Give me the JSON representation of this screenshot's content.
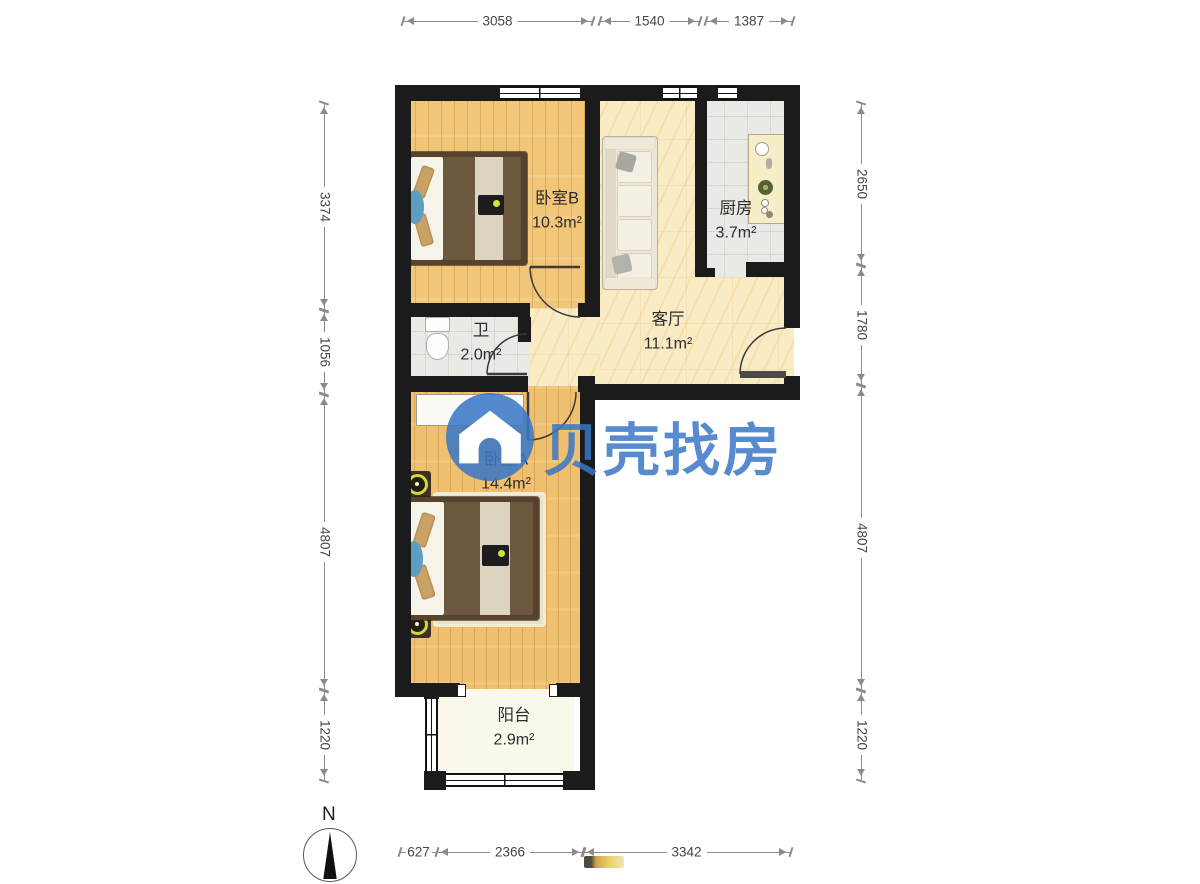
{
  "floorplan": {
    "rooms": {
      "bedroom_b": {
        "name": "卧室B",
        "area": "10.3m²"
      },
      "kitchen": {
        "name": "厨房",
        "area": "3.7m²"
      },
      "living_room": {
        "name": "客厅",
        "area": "11.1m²"
      },
      "bathroom": {
        "name": "卫",
        "area": "2.0m²"
      },
      "bedroom_a": {
        "name": "卧室A",
        "area": "14.4m²"
      },
      "balcony": {
        "name": "阳台",
        "area": "2.9m²"
      }
    },
    "dimensions_mm": {
      "top": [
        "3058",
        "1540",
        "1387"
      ],
      "left": [
        "3374",
        "1056",
        "4807",
        "1220"
      ],
      "right": [
        "2650",
        "1780",
        "4807",
        "1220"
      ],
      "bottom": [
        "627",
        "2366",
        "3342"
      ]
    },
    "compass": {
      "label": "N"
    },
    "watermark": {
      "text": "贝壳找房",
      "logo": "beike-house-logo",
      "color": "#3b76c6"
    },
    "furniture": [
      "double-bed",
      "sofa",
      "kitchen-counter",
      "toilet",
      "desk",
      "nightstand-lamp",
      "rug"
    ],
    "colors": {
      "wall": "#1b1b1b",
      "wood_floor": "#f2c678",
      "living_floor": "#f9ebc4",
      "tile_floor": "#e9e9e5",
      "balcony_floor": "#fbf8ec"
    }
  }
}
